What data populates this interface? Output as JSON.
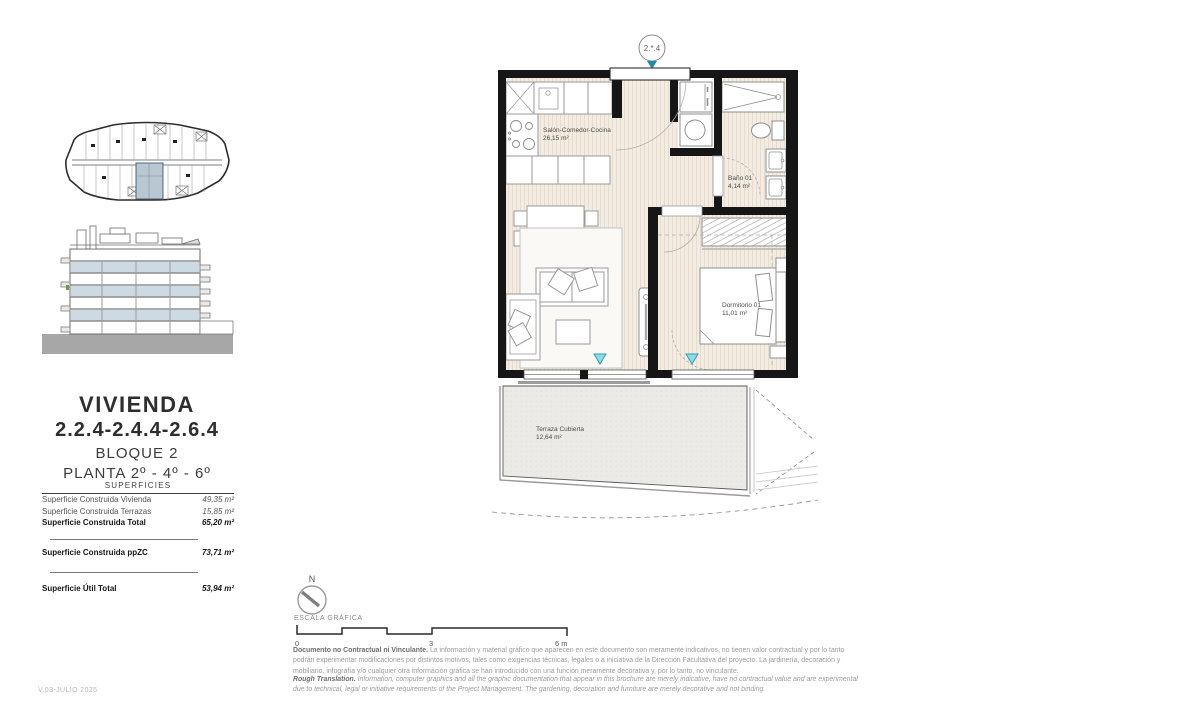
{
  "meta": {
    "version": "V.03-JULIO 2025"
  },
  "sidebar": {
    "title": "VIVIENDA",
    "unit_numbers": "2.2.4-2.4.4-2.6.4",
    "block": "BLOQUE 2",
    "floors": "PLANTA 2º - 4º - 6º",
    "superficies": {
      "header": "SUPERFICIES",
      "rows": [
        {
          "label": "Superficie Construida Vivienda",
          "value": "49,35 m²"
        },
        {
          "label": "Superficie Construida Terrazas",
          "value": "15,85 m²"
        },
        {
          "label": "Superficie Construida Total",
          "value": "65,20 m²"
        },
        {
          "label": "Superficie Construida ppZC",
          "value": "73,71 m²"
        },
        {
          "label": "Superficie Útil Total",
          "value": "53,94 m²"
        }
      ]
    }
  },
  "plan": {
    "unit_badge": "2.*.4",
    "rooms": {
      "salon": {
        "name": "Salón-Comedor-Cocina",
        "area": "26,15 m²"
      },
      "bano": {
        "name": "Baño 01",
        "area": "4,14 m²"
      },
      "dormitorio": {
        "name": "Dormitorio 01",
        "area": "11,01 m²"
      },
      "terraza": {
        "name": "Terraza Cubierta",
        "area": "12,64 m²"
      }
    }
  },
  "footer": {
    "north": "N",
    "scale_label": "ESCALA GRÁFICA",
    "scale_ticks": {
      "start": "0",
      "mid": "3",
      "end": "6 m"
    },
    "disclaimer_es_lead": "Documento no Contractual ni Vinculante.",
    "disclaimer_es_body": " La información y material gráfico que aparecen en este documento son meramente indicativos, no tienen valor contractual y por lo tanto podrán experimentar modificaciones por distintos motivos, tales como exigencias técnicas, legales o a iniciativa de la Dirección Facultativa del proyecto. La jardinería, decoración y mobiliario, infografía y/o cualquier otra información gráfica se han introducido con una función meramente decorativa y, por lo tanto, no vinculante.",
    "disclaimer_en_lead": "Rough Translation.",
    "disclaimer_en_body": " Information, computer graphics and all the graphic documentation that appear in this brochure are merely indicative, have no contractual value and are experimental due to technical, legal or initiative requirements of the Project Management. The gardening, decoration and furniture are merely decorative and not binding."
  },
  "colors": {
    "wall": "#161616",
    "floor_beige": "#f2ece3",
    "terrace_gray": "#edecе8",
    "highlight_unit": "#b9c7d3",
    "elevation_band": "#cdd9e3",
    "marker_teal": "#2ca8bd"
  }
}
